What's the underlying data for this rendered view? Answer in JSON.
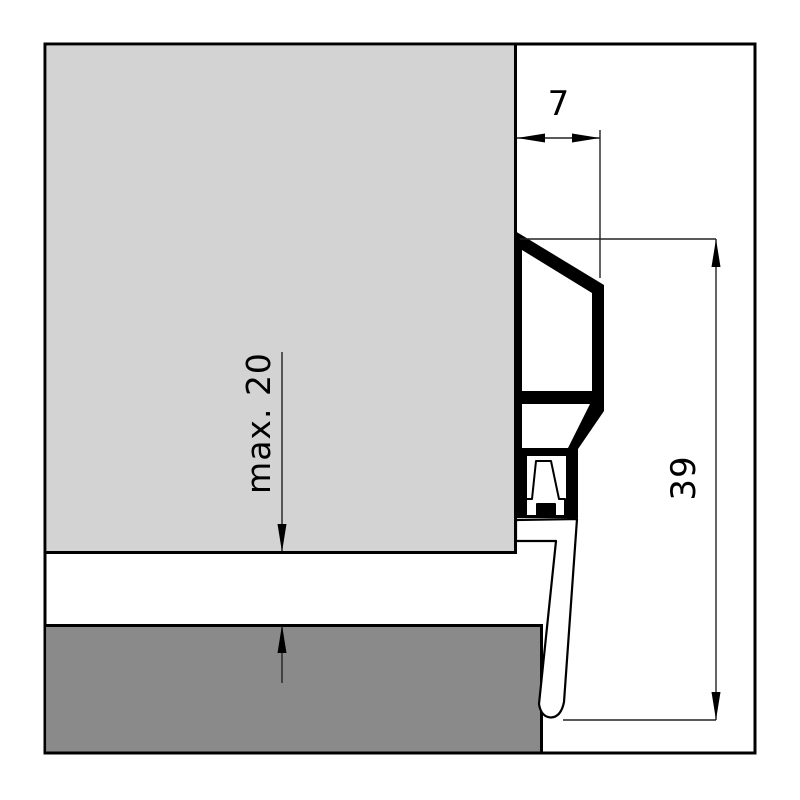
{
  "drawing": {
    "labels": {
      "width_top": "7",
      "height_right": "39",
      "gap_left": "max. 20"
    },
    "colors": {
      "background": "#ffffff",
      "door_fill": "#d3d3d3",
      "floor_fill": "#8a8a8a",
      "line": "#000000",
      "dim_line": "#222222"
    }
  }
}
